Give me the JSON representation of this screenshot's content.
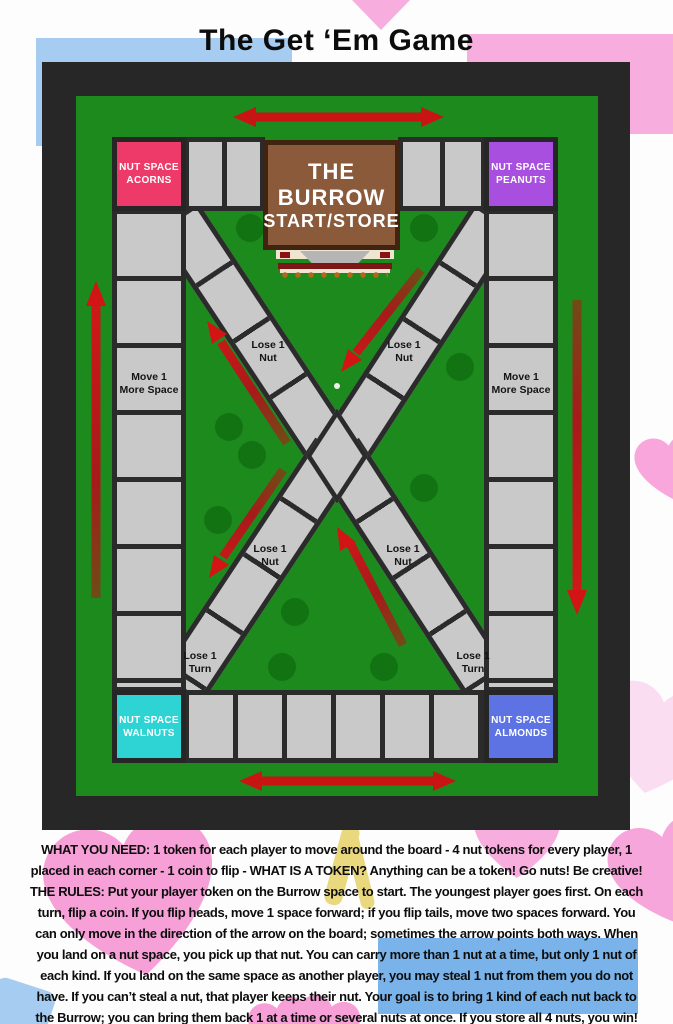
{
  "title": "The Get ‘Em Game",
  "board": {
    "burrow": {
      "line1": "THE BURROW",
      "line2": "START/STORE"
    },
    "corners": {
      "acorns": {
        "line1": "NUT SPACE",
        "line2": "ACORNS",
        "color": "#ee3a69"
      },
      "peanuts": {
        "line1": "NUT SPACE",
        "line2": "PEANUTS",
        "color": "#a94fe0"
      },
      "walnuts": {
        "line1": "NUT SPACE",
        "line2": "WALNUTS",
        "color": "#2ed3d3"
      },
      "almonds": {
        "line1": "NUT SPACE",
        "line2": "ALMONDS",
        "color": "#5d73e3"
      }
    },
    "labels": {
      "move_more": {
        "line1": "Move 1",
        "line2": "More Space"
      },
      "lose_nut": {
        "line1": "Lose 1",
        "line2": "Nut"
      },
      "lose_turn": {
        "line1": "Lose 1",
        "line2": "Turn"
      }
    },
    "colors": {
      "field_green": "#1d8a1d",
      "space_gray": "#c9c9c9",
      "space_border": "#2b2b2b",
      "frame_black": "#272727",
      "arrow_red": "#d01818",
      "burrow_brown": "#8a5a3a"
    },
    "icons": {
      "arrows": [
        "arrow-top-both-icon",
        "arrow-bottom-both-icon",
        "arrow-left-up-icon",
        "arrow-right-down-icon",
        "arrow-diag-upper-left-icon",
        "arrow-diag-upper-right-icon",
        "arrow-diag-lower-left-icon",
        "arrow-diag-lower-right-icon"
      ],
      "decor": [
        "bush-icon",
        "heart-icon",
        "burrow-entrance-icon"
      ]
    }
  },
  "rules": {
    "lines": [
      "WHAT YOU NEED: 1 token for each player to move around the board - 4 nut tokens for every player, 1",
      "placed in each corner - 1 coin to flip - WHAT IS A TOKEN? Anything can be a token! Go nuts! Be creative!",
      "THE RULES: Put your player token on the Burrow space to start. The youngest player goes first. On each",
      "turn, flip a coin. If you flip heads, move 1 space forward; if you flip tails, move two spaces forward. You",
      "can only move in the direction of the arrow on the board; sometimes the arrow points both ways. When",
      "you land on a nut space, you pick up that nut. You can carry more than 1 nut at a time, but only 1 nut of",
      "each kind. If you land on the same space as another player, you may steal 1 nut from them you do not",
      "have. If you can’t steal a nut, that player keeps their nut. Your goal is to bring 1 kind of each nut back to",
      "the Burrow; you can bring them back 1 at a time or several nuts at once. If you store all 4 nuts, you win!"
    ]
  }
}
